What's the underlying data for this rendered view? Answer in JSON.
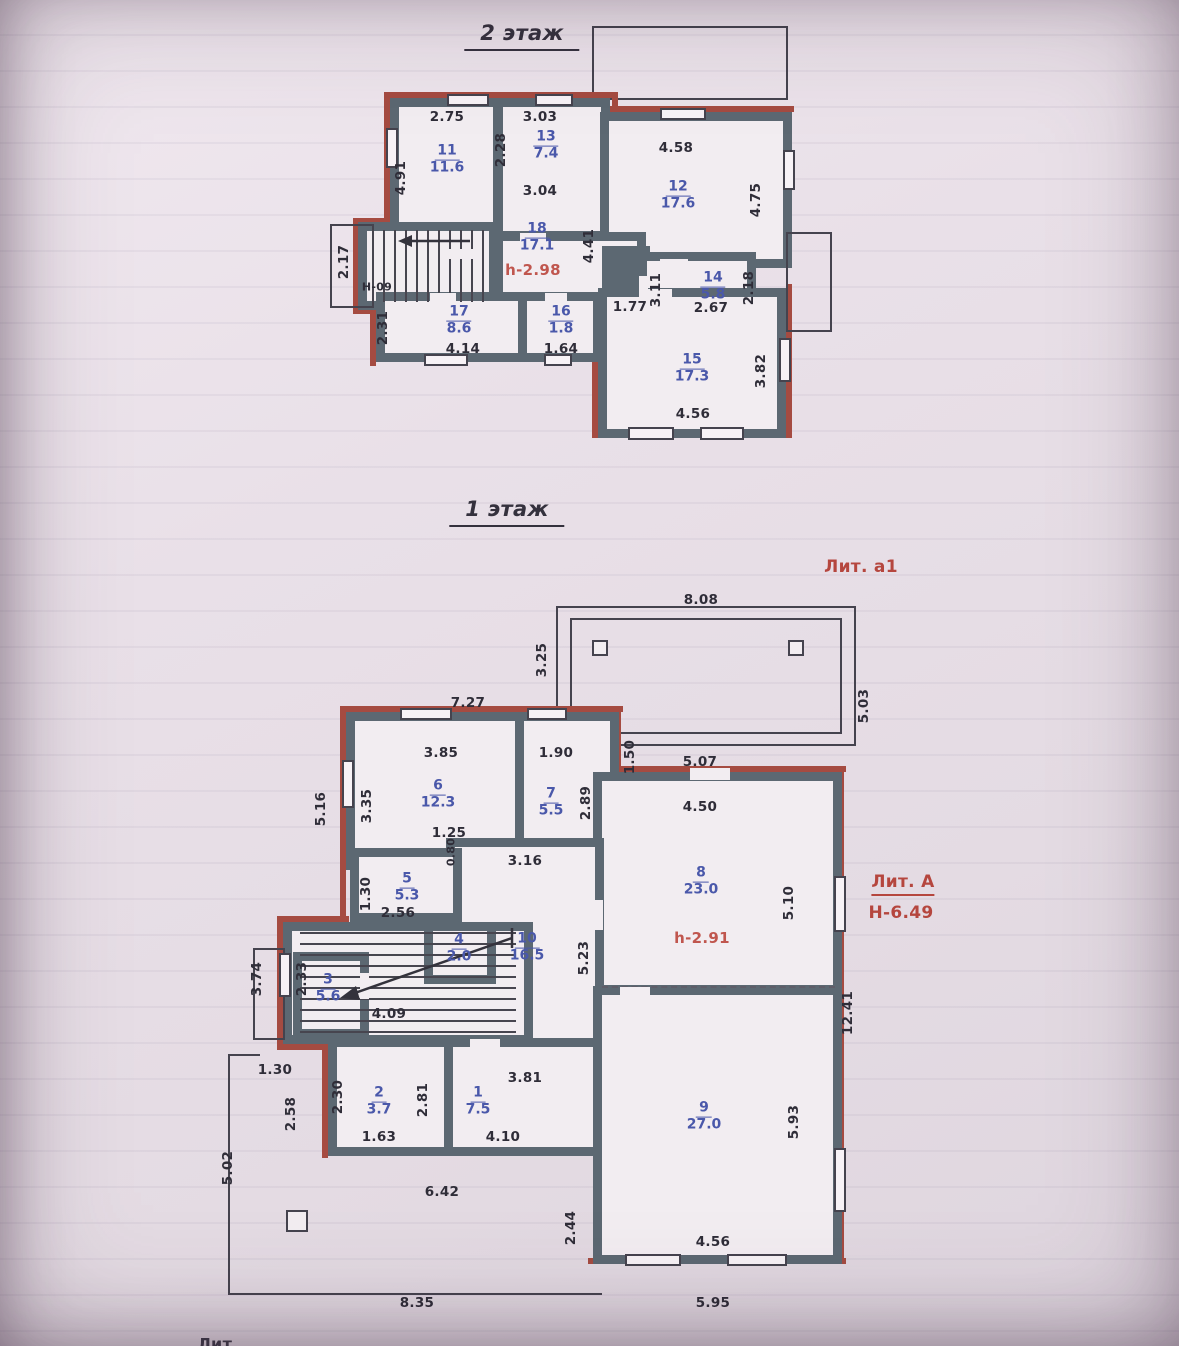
{
  "page": {
    "corner_note": "Лит."
  },
  "colors": {
    "wall": "#5c6872",
    "brick": "#a54b41",
    "room_label": "#4a58aa",
    "annotation_red": "#b5463e",
    "ink": "#2f2d38"
  },
  "floor2": {
    "title": "2 этаж",
    "height_note": "h-2.98",
    "rooms": [
      {
        "num": "11",
        "area": "11.6",
        "x": 447,
        "y": 160
      },
      {
        "num": "13",
        "area": "7.4",
        "x": 546,
        "y": 146
      },
      {
        "num": "12",
        "area": "17.6",
        "x": 678,
        "y": 196
      },
      {
        "num": "18",
        "area": "17.1",
        "x": 537,
        "y": 238
      },
      {
        "num": "14",
        "area": "5.8",
        "x": 713,
        "y": 287
      },
      {
        "num": "17",
        "area": "8.6",
        "x": 459,
        "y": 321
      },
      {
        "num": "16",
        "area": "1.8",
        "x": 561,
        "y": 321
      },
      {
        "num": "15",
        "area": "17.3",
        "x": 692,
        "y": 369
      }
    ],
    "dims": [
      {
        "t": "2.75",
        "x": 447,
        "y": 117
      },
      {
        "t": "3.03",
        "x": 540,
        "y": 117
      },
      {
        "t": "4.91",
        "x": 401,
        "y": 178,
        "v": true
      },
      {
        "t": "2.28",
        "x": 501,
        "y": 150,
        "v": true
      },
      {
        "t": "3.04",
        "x": 540,
        "y": 191
      },
      {
        "t": "4.58",
        "x": 676,
        "y": 148
      },
      {
        "t": "4.75",
        "x": 756,
        "y": 200,
        "v": true
      },
      {
        "t": "4.41",
        "x": 589,
        "y": 246,
        "v": true
      },
      {
        "t": "2.17",
        "x": 344,
        "y": 262,
        "v": true
      },
      {
        "t": "2.31",
        "x": 383,
        "y": 328,
        "v": true
      },
      {
        "t": "3.11",
        "x": 656,
        "y": 290,
        "v": true
      },
      {
        "t": "1.77",
        "x": 630,
        "y": 307
      },
      {
        "t": "2.67",
        "x": 711,
        "y": 308
      },
      {
        "t": "2.18",
        "x": 749,
        "y": 288,
        "v": true
      },
      {
        "t": "4.14",
        "x": 463,
        "y": 349
      },
      {
        "t": "1.64",
        "x": 561,
        "y": 349
      },
      {
        "t": "3.82",
        "x": 761,
        "y": 371,
        "v": true
      },
      {
        "t": "4.56",
        "x": 693,
        "y": 414
      },
      {
        "t": "Н-09",
        "x": 377,
        "y": 287,
        "cls": "small"
      }
    ]
  },
  "floor1": {
    "title": "1 этаж",
    "porch_label": "Лит. а1",
    "building_label": "Лит. А",
    "building_height": "Н-6.49",
    "height_note": "h-2.91",
    "rooms": [
      {
        "num": "6",
        "area": "12.3",
        "x": 438,
        "y": 795
      },
      {
        "num": "7",
        "area": "5.5",
        "x": 551,
        "y": 803
      },
      {
        "num": "8",
        "area": "23.0",
        "x": 701,
        "y": 882
      },
      {
        "num": "5",
        "area": "5.3",
        "x": 407,
        "y": 888
      },
      {
        "num": "10",
        "area": "16.5",
        "x": 527,
        "y": 948
      },
      {
        "num": "4",
        "area": "2.0",
        "x": 459,
        "y": 949
      },
      {
        "num": "3",
        "area": "5.6",
        "x": 328,
        "y": 989
      },
      {
        "num": "2",
        "area": "3.7",
        "x": 379,
        "y": 1102
      },
      {
        "num": "1",
        "area": "7.5",
        "x": 478,
        "y": 1102
      },
      {
        "num": "9",
        "area": "27.0",
        "x": 704,
        "y": 1117
      }
    ],
    "dims": [
      {
        "t": "8.08",
        "x": 701,
        "y": 600
      },
      {
        "t": "3.25",
        "x": 542,
        "y": 660,
        "v": true
      },
      {
        "t": "5.03",
        "x": 864,
        "y": 706,
        "v": true
      },
      {
        "t": "7.27",
        "x": 468,
        "y": 703
      },
      {
        "t": "1.50",
        "x": 630,
        "y": 757,
        "v": true
      },
      {
        "t": "5.07",
        "x": 700,
        "y": 762
      },
      {
        "t": "3.85",
        "x": 441,
        "y": 753
      },
      {
        "t": "1.90",
        "x": 556,
        "y": 753
      },
      {
        "t": "4.50",
        "x": 700,
        "y": 807
      },
      {
        "t": "3.35",
        "x": 367,
        "y": 806,
        "v": true
      },
      {
        "t": "5.16",
        "x": 321,
        "y": 809,
        "v": true
      },
      {
        "t": "2.89",
        "x": 586,
        "y": 803,
        "v": true
      },
      {
        "t": "1.25",
        "x": 449,
        "y": 833
      },
      {
        "t": "0.80",
        "x": 451,
        "y": 852,
        "v": true,
        "cls": "small"
      },
      {
        "t": "3.16",
        "x": 525,
        "y": 861
      },
      {
        "t": "1.30",
        "x": 366,
        "y": 894,
        "v": true
      },
      {
        "t": "2.56",
        "x": 398,
        "y": 913
      },
      {
        "t": "5.23",
        "x": 584,
        "y": 958,
        "v": true
      },
      {
        "t": "5.10",
        "x": 789,
        "y": 903,
        "v": true
      },
      {
        "t": "2.33",
        "x": 302,
        "y": 979,
        "v": true
      },
      {
        "t": "3.74",
        "x": 257,
        "y": 979,
        "v": true
      },
      {
        "t": "4.09",
        "x": 389,
        "y": 1014
      },
      {
        "t": "12.41",
        "x": 848,
        "y": 1013,
        "v": true
      },
      {
        "t": "2.30",
        "x": 338,
        "y": 1097,
        "v": true
      },
      {
        "t": "2.81",
        "x": 423,
        "y": 1100,
        "v": true
      },
      {
        "t": "3.81",
        "x": 525,
        "y": 1078
      },
      {
        "t": "1.63",
        "x": 379,
        "y": 1137
      },
      {
        "t": "4.10",
        "x": 503,
        "y": 1137
      },
      {
        "t": "5.93",
        "x": 794,
        "y": 1122,
        "v": true
      },
      {
        "t": "1.30",
        "x": 275,
        "y": 1070
      },
      {
        "t": "2.58",
        "x": 291,
        "y": 1114,
        "v": true
      },
      {
        "t": "5.02",
        "x": 228,
        "y": 1168,
        "v": true
      },
      {
        "t": "6.42",
        "x": 442,
        "y": 1192
      },
      {
        "t": "2.44",
        "x": 571,
        "y": 1228,
        "v": true
      },
      {
        "t": "4.56",
        "x": 713,
        "y": 1242
      },
      {
        "t": "8.35",
        "x": 417,
        "y": 1303
      },
      {
        "t": "5.95",
        "x": 713,
        "y": 1303
      }
    ]
  }
}
